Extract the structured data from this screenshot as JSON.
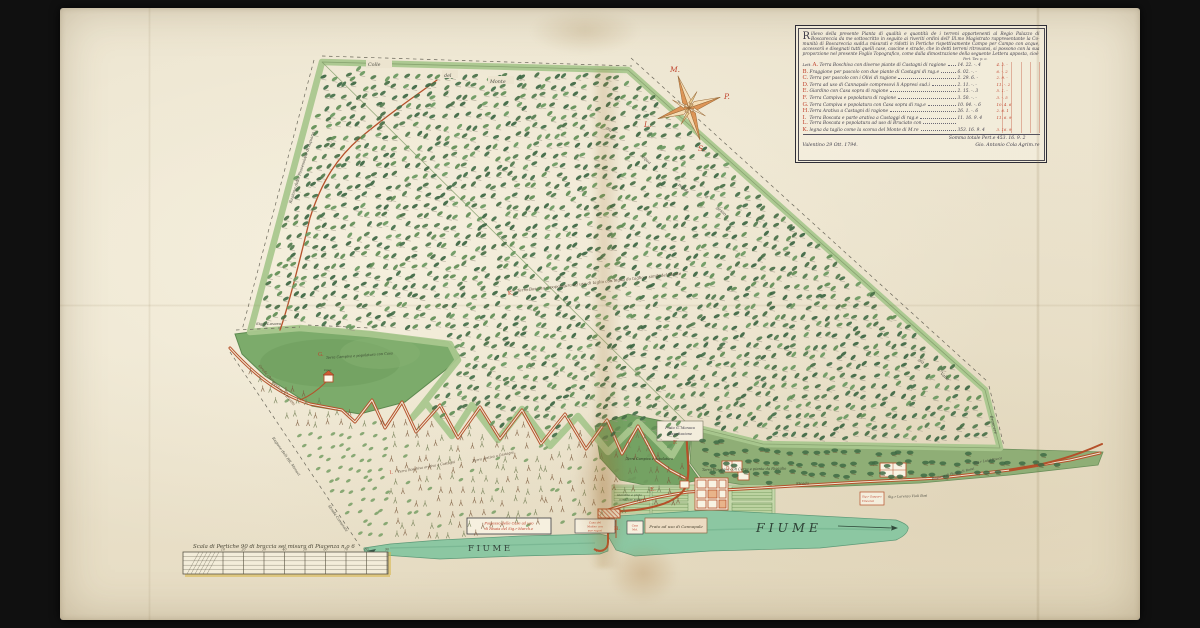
{
  "legend": {
    "initial": "R",
    "paragraph": [
      "ilievo della presente Pianta di qualità e quantità de i terreni appartenenti al Regio Palazzo di",
      "Boscareccia da me sottoscritto in seguito ai riveriti ordini dell' Ill.mo Magistrato rappresentante la Co-",
      "munità di Boscareccia sudd.a misurati e ridotti in Pertiche rispettivamente Campo per Campo con",
      "acque, accessorii e disegnati tutti quelli case, cascine e strade, che in detti terreni ritrovansi, si",
      "possono con la sua proporzione nel presente Foglio Topografico, come dalla dimostrazione",
      "della seguente Lettera apposta, cioè"
    ],
    "col_headers": "Pert.  Tav.  p.  o.",
    "list_prefix": "Lett.",
    "rows": [
      {
        "letter": "A.",
        "text": "Terra Boschiva con diverse piante di Castagni di ragione",
        "nums": "14. 22. -. 4",
        "red": "4. 2. -"
      },
      {
        "letter": "B.",
        "text": "Fraggione per pascolo con due piante di Castagni di rag.e",
        "nums": "6. 02. -. -",
        "red": "6. -. 2"
      },
      {
        "letter": "C.",
        "text": "Terra per pascolo con i Olivi di ragione",
        "nums": "2. 29. 6. -",
        "red": "2. 9. -"
      },
      {
        "letter": "D.",
        "text": "Terra ad uso di Cannapale compresovi li Appresi sud.i",
        "nums": "2. 11. -. -",
        "red": "11. -. 2"
      },
      {
        "letter": "E.",
        "text": "Giardino con Casa sopra di ragione",
        "nums": "2. 15. -. 3",
        "red": "5. 1. -"
      },
      {
        "letter": "F.",
        "text": "Terra Campiva e popolatura di ragione",
        "nums": "3. 50. -. -",
        "red": "3. -. 5"
      },
      {
        "letter": "G.",
        "text": "Terra Campiva e popolatura con Casa sopra di rag.e",
        "nums": "10. 04. -. 6",
        "red": "10. 4. 6"
      },
      {
        "letter": "H.",
        "text": "Terra Arativa a Castagni di ragione",
        "nums": "26. 1. -. 6",
        "red": "2. 6. 1"
      },
      {
        "letter": "I.",
        "text": "Terra Boscata e parte arativa a Castaggi di rag.e",
        "nums": "11. 16. 9. 4",
        "red": "11. 6. 9"
      },
      {
        "letter": "L.",
        "text": "Terra Boscata e popolatura ad uso di Bruciato con",
        "nums": "",
        "red": ""
      },
      {
        "letter": "K.",
        "text": "legna da taglio come la scorsa del Monte di M.re",
        "nums": "353. 16. 9. 4",
        "red": "3. 16. 9"
      }
    ],
    "totals": "Somma totale Pert.e 453. 16. 9. 2",
    "date": "Valentino 29 Ott. 1794.",
    "signature": "Gio. Antonio Cola Agrim.re"
  },
  "compass": {
    "north": "M.",
    "east": "P.",
    "south": "S.",
    "west": "L."
  },
  "map": {
    "boundary_top": [
      "Colle",
      "del",
      "Monte"
    ],
    "slope_words": [
      "già",
      "acqua",
      "pende",
      "a",
      "gesso"
    ],
    "corner_words": [
      "già",
      "Valle"
    ],
    "boundary_left": "Ragione della Possessione di Aquana",
    "boundary_right": "Brancere",
    "boundary_bottom_1": "Ragione delli RR. Monaci",
    "boundary_bottom_2": "Strada Comunale",
    "patch": {
      "owner": "Sig.r Lovara",
      "road_label": "Strada che conduce a Rivalta",
      "letter": "G.",
      "label": "Terra Campiva e popolatura con Casa",
      "casa": "Casa"
    },
    "forest": {
      "letter": "K.",
      "label": "Terra Boscata e popolatura ad uso di taglio con legna da taglio e simili del Monte"
    },
    "orchard": {
      "letter": "I.",
      "label1": "Terra Boschiva arativa a Castagni",
      "label2": "Terra arativa a Castagni"
    },
    "strip": {
      "label": "Terra Boschiva con Cerze e piante da Rigaglio",
      "road_label": "Strada"
    },
    "darkzone": {
      "letter": "F.",
      "label": "Terra Campiva e popolatura"
    },
    "field": {
      "letter": "E.",
      "label1": "Giardino e prato",
      "label2": "con Case sopra"
    },
    "right_labels": {
      "r1": "Ragione di Biagio di Rossi",
      "r2": "Sig.r Luigi Rocca",
      "r3": "Sig.r Lorenzo Violi Bosi",
      "box1": "Sig.r Gasparo",
      "box2": "Vincenzi"
    },
    "boxes": {
      "possesso1": "Possesso delle Case ad uso",
      "possesso2": "di Risaia del Sig.r March.e",
      "molino1": "Casa del",
      "molino2": "Molino con",
      "molino3": "sue rag.ni",
      "casello1": "Casa",
      "casello2": "Mol.",
      "prato": "Prato ad uso di Cannapale",
      "prato_casa1": "Prato G. Monaca",
      "prato_casa2": "Rispettazione"
    },
    "bridge": {
      "label": "Pon.",
      "letter": "H."
    },
    "building_letter": "D.",
    "river_left": "F I U M E",
    "river_right": "F I U M E"
  },
  "scale_bar": {
    "title": "Scala di Pertiche 90 di braccia sei misura di Piacenza n.o 6",
    "ticks": [
      "10",
      "20",
      "30",
      "40",
      "50",
      "60",
      "70",
      "80",
      "90"
    ]
  },
  "colors": {
    "parchment": "#ece4cf",
    "forest_green": "#47724a",
    "border_green": "#a9c78e",
    "river_green": "#8cc7a2",
    "road_red": "#b5502a",
    "ink": "#3e3c49",
    "red_ink": "#c0442e"
  }
}
